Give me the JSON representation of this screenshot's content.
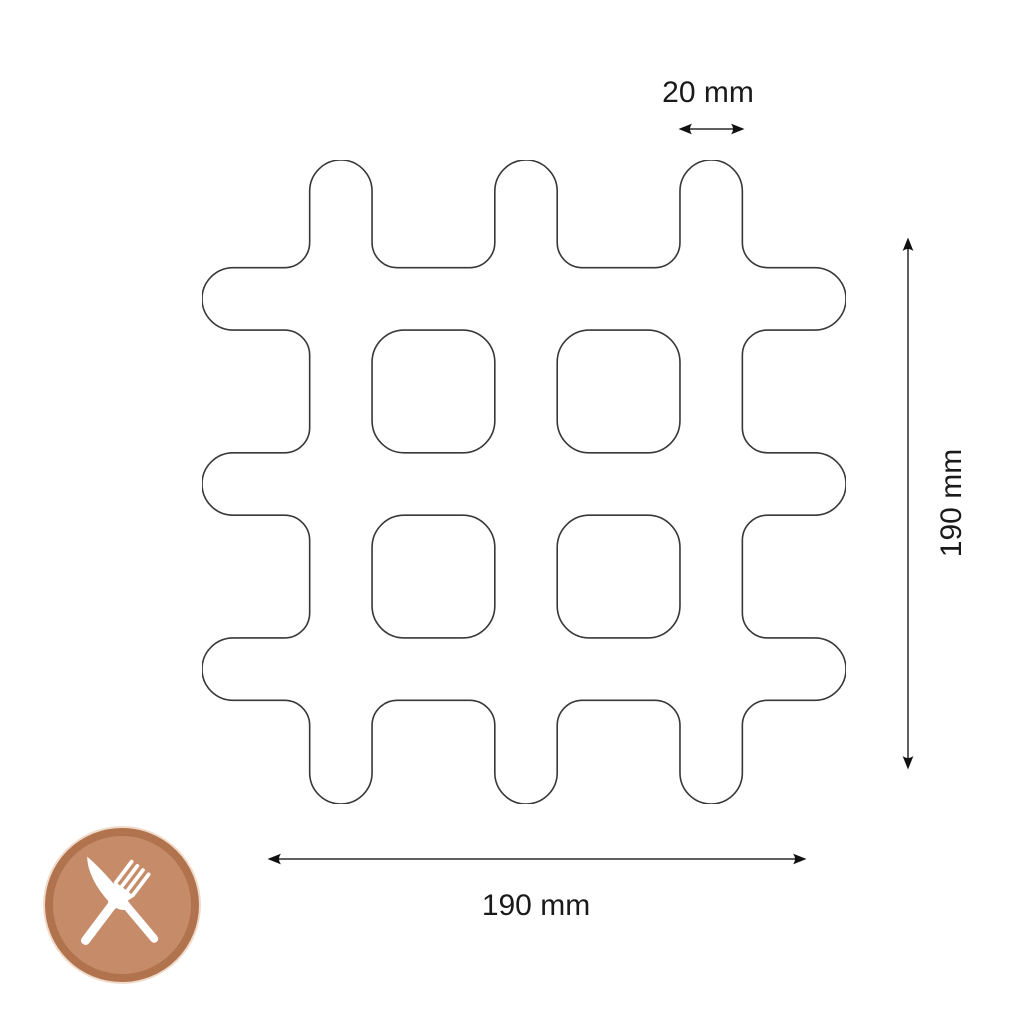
{
  "diagram": {
    "type": "product-dimension-diagram",
    "subject": "grid trivet (hash-shaped pan rest), top view outline",
    "dimensions": {
      "bar_width": {
        "label": "20 mm",
        "measures": "width of one bar / finger"
      },
      "height": {
        "label": "190 mm",
        "measures": "overall height"
      },
      "width": {
        "label": "190 mm",
        "measures": "overall width"
      }
    },
    "icons": {
      "badge": "cutlery-icon"
    },
    "colors": {
      "background": "#ffffff",
      "outline": "#383838",
      "arrow_line": "#606060",
      "arrow_head": "#111111",
      "text": "#1a1a1a",
      "badge_fill": "#c68c6a",
      "badge_ring": "#b0734d",
      "badge_halo": "#f0dbcb",
      "cutlery": "#ffffff"
    }
  }
}
